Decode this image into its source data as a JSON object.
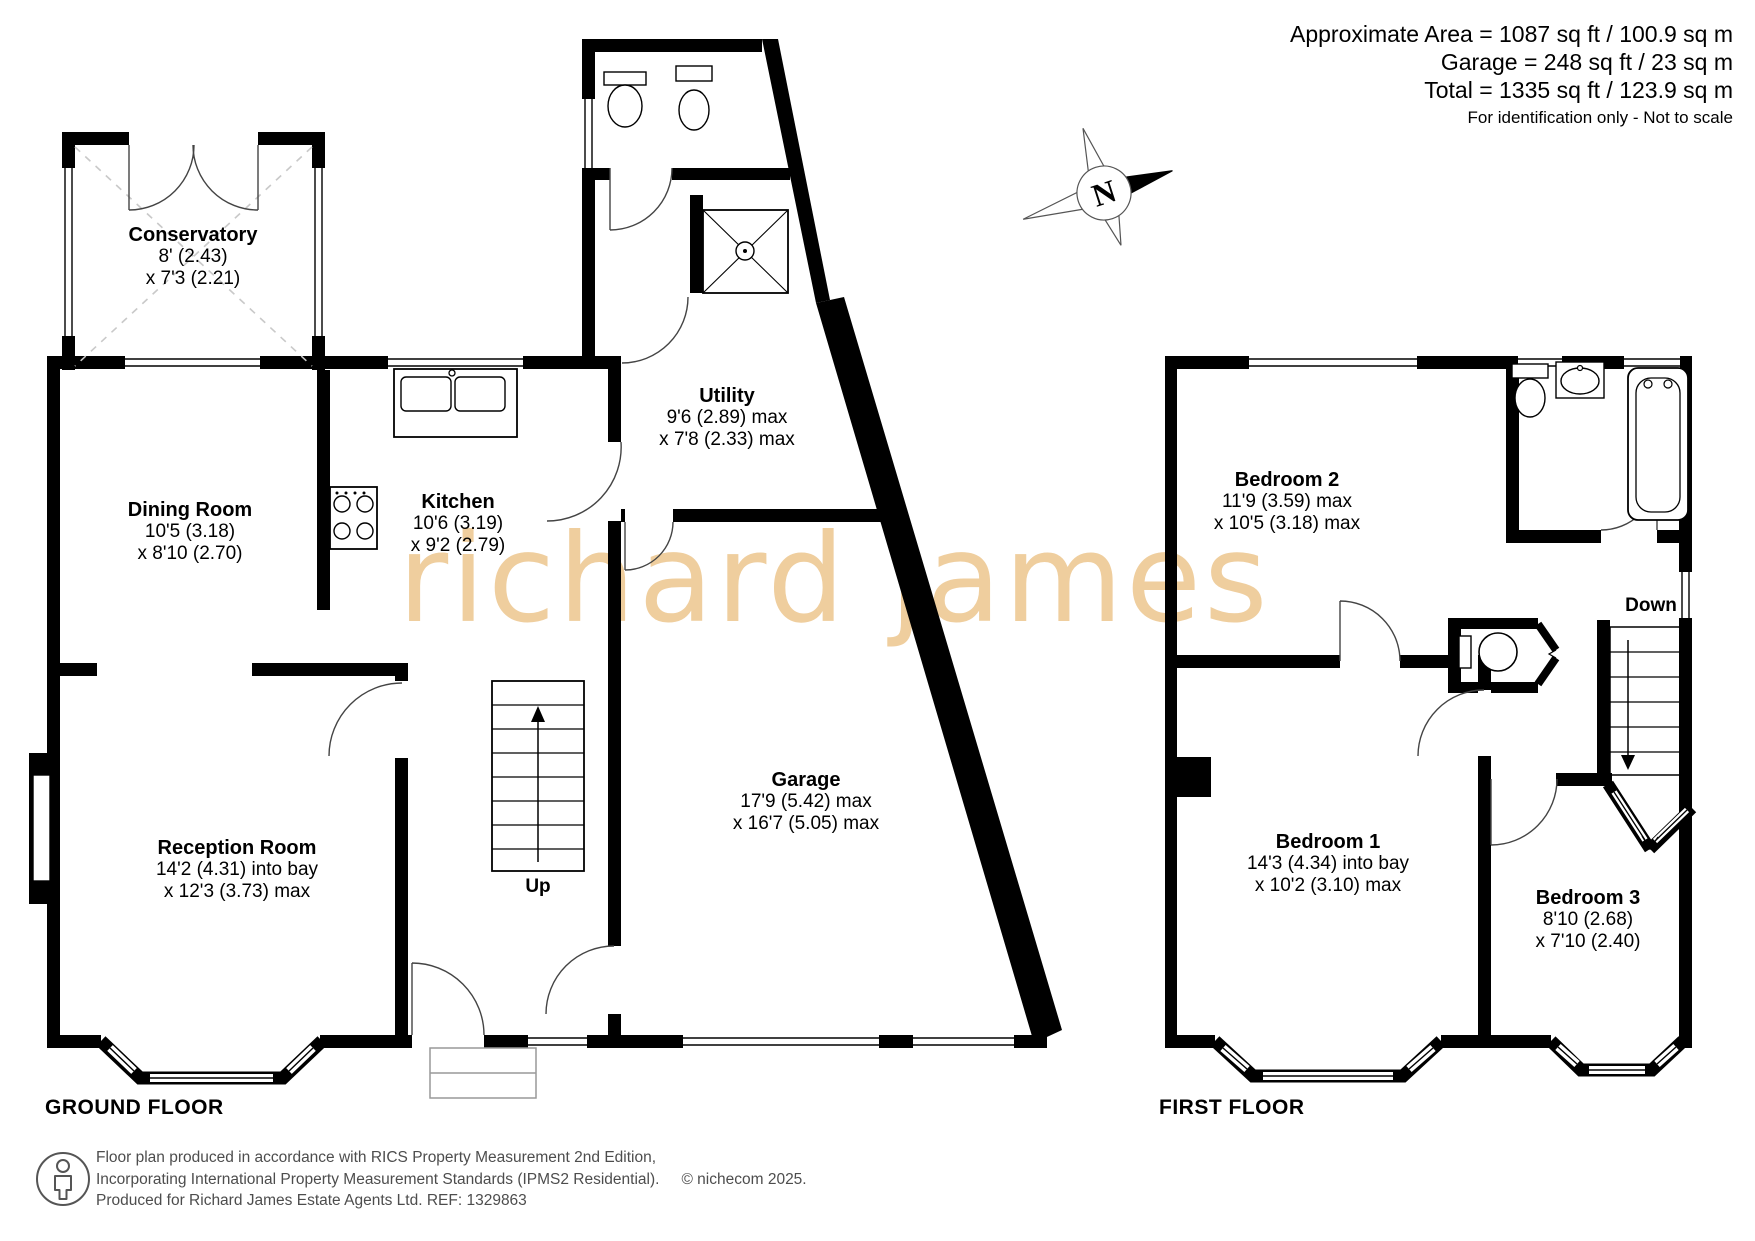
{
  "header": {
    "area_line": "Approximate Area = 1087 sq ft / 100.9 sq m",
    "garage_line": "Garage = 248 sq ft / 23 sq m",
    "total_line": "Total = 1335 sq ft / 123.9 sq m",
    "disclaimer": "For identification only - Not to scale"
  },
  "compass": {
    "north_label": "N"
  },
  "watermark": {
    "text": "richard james"
  },
  "ground_floor": {
    "title": "GROUND FLOOR",
    "up_label": "Up",
    "rooms": [
      {
        "name": "Conservatory",
        "dims": [
          "8' (2.43)",
          "x 7'3 (2.21)"
        ]
      },
      {
        "name": "Dining Room",
        "dims": [
          "10'5 (3.18)",
          "x 8'10 (2.70)"
        ]
      },
      {
        "name": "Kitchen",
        "dims": [
          "10'6 (3.19)",
          "x 9'2 (2.79)"
        ]
      },
      {
        "name": "Utility",
        "dims": [
          "9'6 (2.89) max",
          "x 7'8 (2.33) max"
        ]
      },
      {
        "name": "Garage",
        "dims": [
          "17'9 (5.42) max",
          "x 16'7 (5.05) max"
        ]
      },
      {
        "name": "Reception Room",
        "dims": [
          "14'2 (4.31) into bay",
          "x 12'3 (3.73) max"
        ]
      }
    ]
  },
  "first_floor": {
    "title": "FIRST FLOOR",
    "down_label": "Down",
    "rooms": [
      {
        "name": "Bedroom 2",
        "dims": [
          "11'9 (3.59) max",
          "x 10'5 (3.18) max"
        ]
      },
      {
        "name": "Bedroom 1",
        "dims": [
          "14'3 (4.34) into bay",
          "x 10'2 (3.10) max"
        ]
      },
      {
        "name": "Bedroom 3",
        "dims": [
          "8'10 (2.68)",
          "x 7'10 (2.40)"
        ]
      }
    ]
  },
  "footer": {
    "line1": "Floor plan produced in accordance with RICS Property Measurement 2nd Edition,",
    "line2": "Incorporating International Property Measurement Standards (IPMS2 Residential).",
    "copyright": "© nichecom 2025.",
    "line3": "Produced for Richard James Estate Agents Ltd.   REF: 1329863"
  },
  "colors": {
    "wall": "#000000",
    "watermark": "#efce9e",
    "dashed_line": "#c9c9c9",
    "footer_text": "#4d4d4d"
  }
}
